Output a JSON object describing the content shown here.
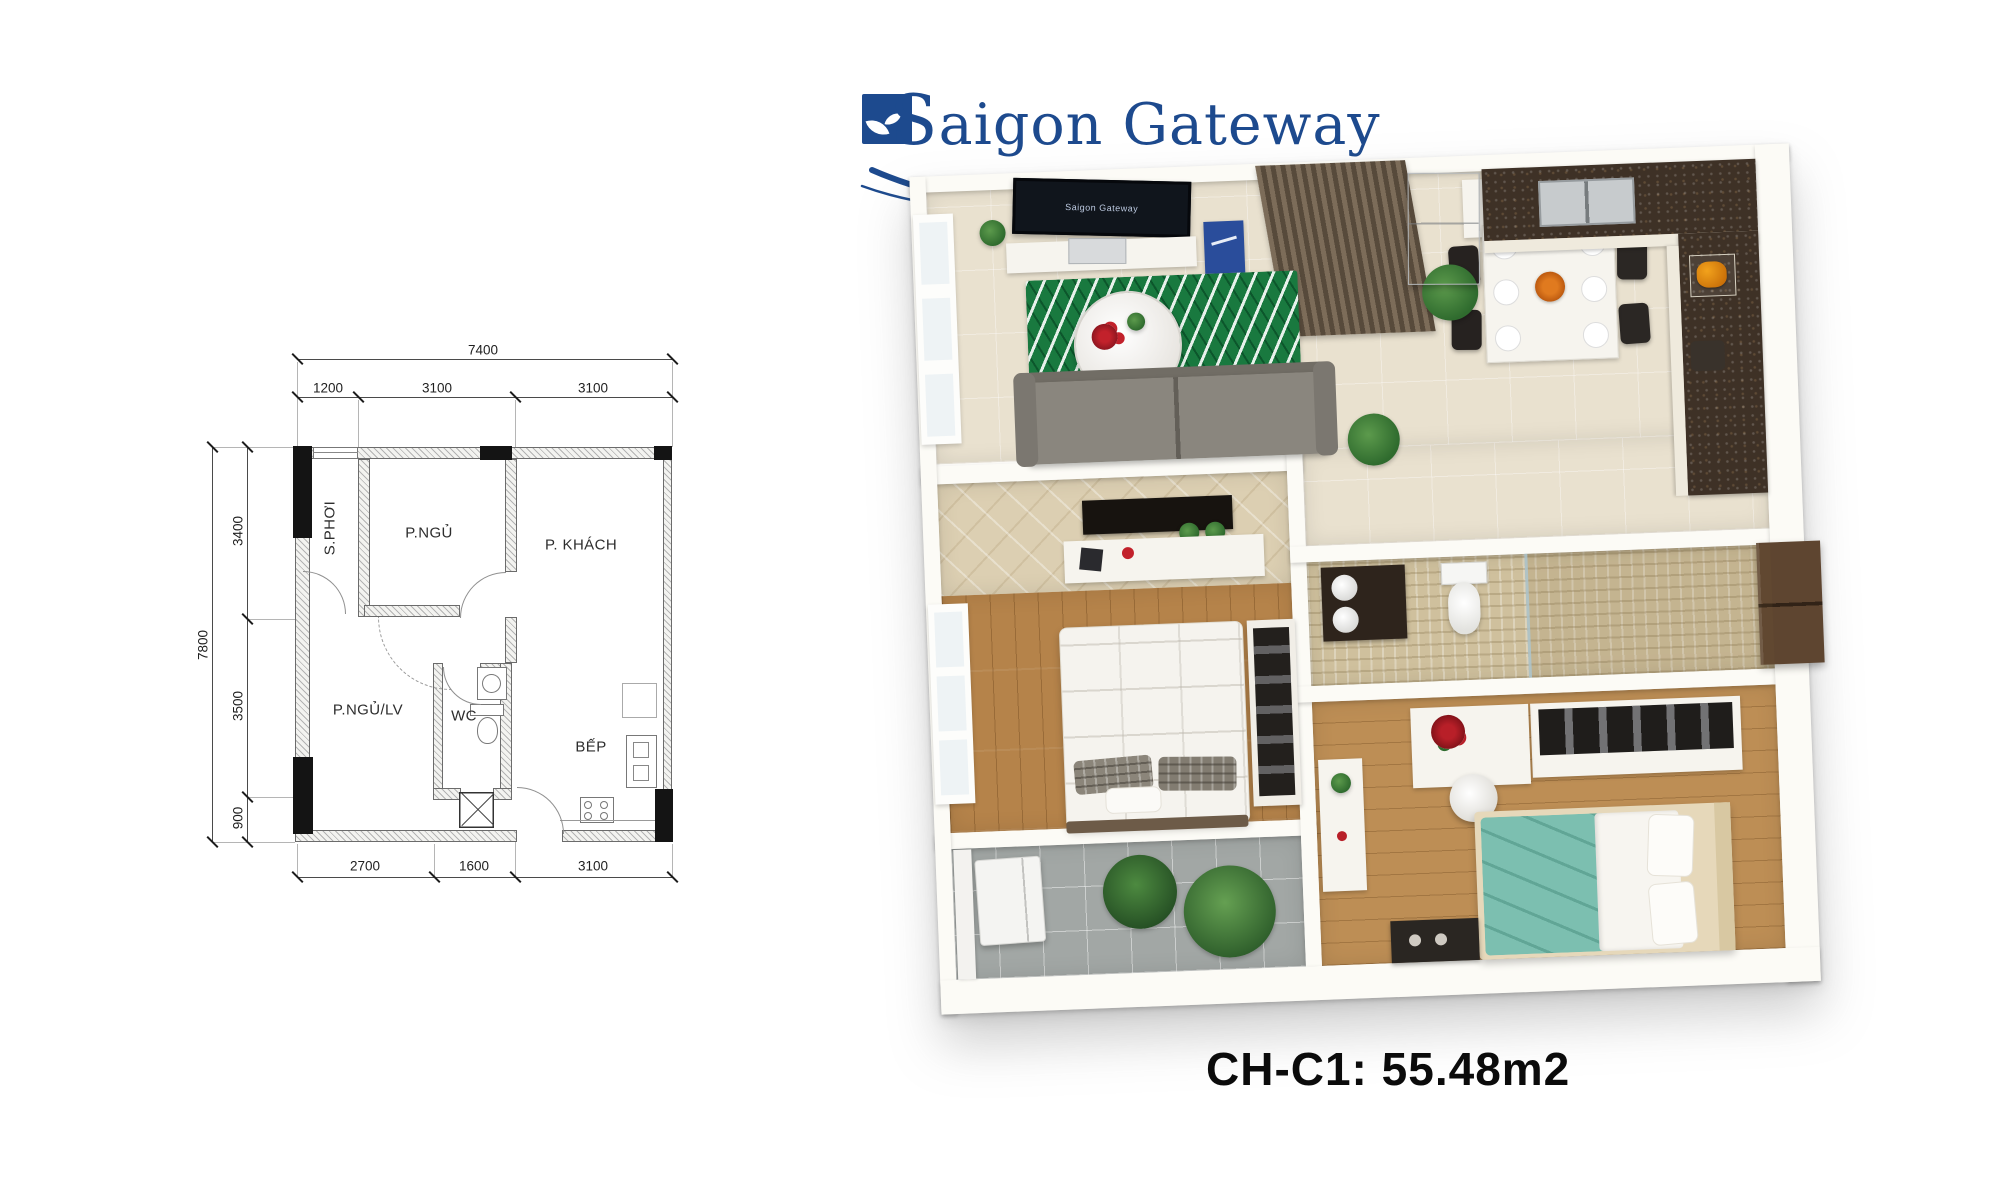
{
  "logo": {
    "text": "Saigon Gateway",
    "color": "#1d4a8e"
  },
  "caption": {
    "text": "CH-C1: 55.48m2"
  },
  "plan2d": {
    "dim_top_total": "7400",
    "dim_top_segments": [
      "1200",
      "3100",
      "3100"
    ],
    "dim_left_total": "7800",
    "dim_left_segments": [
      "3400",
      "3500",
      "900"
    ],
    "dim_bottom_segments": [
      "2700",
      "1600",
      "3100"
    ],
    "rooms": {
      "sphoi": "S.PHƠI",
      "pngu": "P.NGỦ",
      "pkhach": "P. KHÁCH",
      "pngulv": "P.NGỦ/LV",
      "wc": "WC",
      "bep": "BẾP"
    }
  },
  "plan3d": {
    "tv_screen_text": "Saigon Gateway"
  }
}
